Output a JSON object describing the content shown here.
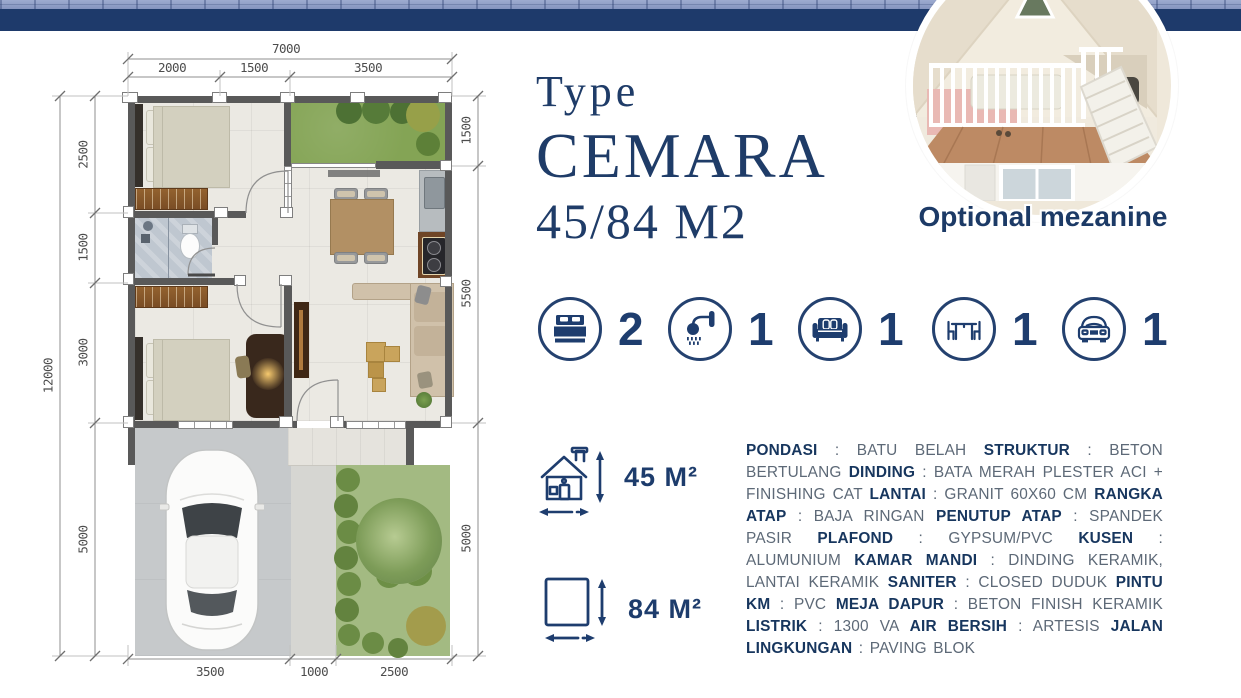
{
  "header": {
    "type_label": "Type",
    "name": "CEMARA",
    "size": "45/84 M2"
  },
  "photo": {
    "caption": "Optional mezanine"
  },
  "features": {
    "items": [
      {
        "name": "bedrooms",
        "count": "2"
      },
      {
        "name": "bathrooms",
        "count": "1"
      },
      {
        "name": "living-room",
        "count": "1"
      },
      {
        "name": "dining-set",
        "count": "1"
      },
      {
        "name": "carport",
        "count": "1"
      }
    ]
  },
  "areas": {
    "building_label": "45 M²",
    "land_label": "84 M²"
  },
  "specs": {
    "runs": [
      {
        "t": "PONDASI",
        "b": true
      },
      {
        "t": " : BATU BELAH ",
        "b": false
      },
      {
        "t": "STRUKTUR",
        "b": true
      },
      {
        "t": " : BETON BERTULANG ",
        "b": false
      },
      {
        "t": "DINDING",
        "b": true
      },
      {
        "t": " : BATA MERAH PLESTER ACI + FINISHING CAT ",
        "b": false
      },
      {
        "t": "LANTAI",
        "b": true
      },
      {
        "t": " : GRANIT 60X60 CM ",
        "b": false
      },
      {
        "t": "RANGKA ATAP",
        "b": true
      },
      {
        "t": " : BAJA RINGAN ",
        "b": false
      },
      {
        "t": "PENUTUP ATAP",
        "b": true
      },
      {
        "t": " : SPANDEK PASIR ",
        "b": false
      },
      {
        "t": "PLAFOND",
        "b": true
      },
      {
        "t": " : GYPSUM/PVC ",
        "b": false
      },
      {
        "t": "KUSEN",
        "b": true
      },
      {
        "t": " : ALUMUNIUM ",
        "b": false
      },
      {
        "t": "KAMAR MANDI",
        "b": true
      },
      {
        "t": " : DINDING KERAMIK, LANTAI KERAMIK ",
        "b": false
      },
      {
        "t": "SANITER",
        "b": true
      },
      {
        "t": " : CLOSED DUDUK ",
        "b": false
      },
      {
        "t": "PINTU KM",
        "b": true
      },
      {
        "t": " : PVC  ",
        "b": false
      },
      {
        "t": "MEJA DAPUR",
        "b": true
      },
      {
        "t": " : BETON FINISH KERAMIK ",
        "b": false
      },
      {
        "t": "LISTRIK",
        "b": true
      },
      {
        "t": " : 1300 VA ",
        "b": false
      },
      {
        "t": "AIR BERSIH",
        "b": true
      },
      {
        "t": " : ARTESIS ",
        "b": false
      },
      {
        "t": "JALAN LINGKUNGAN",
        "b": true
      },
      {
        "t": " : PAVING BLOK",
        "b": false
      }
    ]
  },
  "plan": {
    "dims": {
      "top_total": "7000",
      "top_segments": [
        "2000",
        "1500",
        "3500"
      ],
      "left_total": "12000",
      "left_segments": [
        "2500",
        "1500",
        "3000",
        "5000"
      ],
      "right_segments": [
        "1500",
        "5500",
        "5000"
      ],
      "bottom_segments": [
        "3500",
        "1000",
        "2500"
      ]
    }
  },
  "colors": {
    "accent_navy": "#1d3c6c",
    "band_navy": "#1e3a6b",
    "wall_gray": "#595959",
    "grass_green": "#84a455",
    "garden_green": "#a3ba82",
    "carport_gray": "#c6c9cb",
    "spec_text_gray": "#5d6977"
  }
}
